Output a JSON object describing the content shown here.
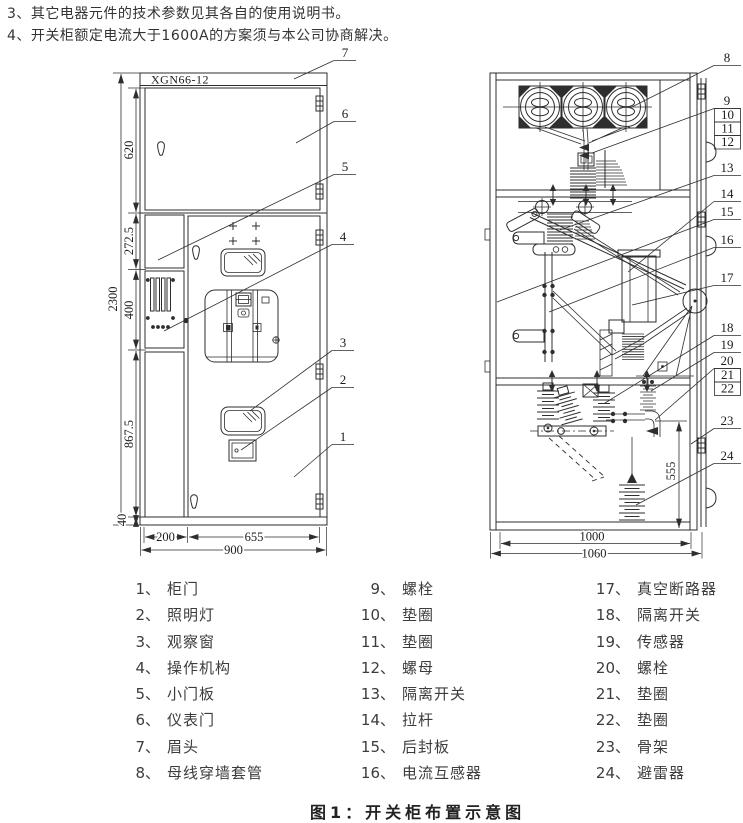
{
  "notes": [
    "3、其它电器元件的技术参数见其各自的使用说明书。",
    "4、开关柜额定电流大于1600A的方案须与本公司协商解决。"
  ],
  "front_view": {
    "model_label": "XGN66-12",
    "overall_height": "2300",
    "section_heights": [
      "620",
      "272.5",
      "400",
      "867.5",
      "40"
    ],
    "widths": [
      "200",
      "655",
      "900"
    ],
    "callouts": [
      "7",
      "6",
      "5",
      "4",
      "3",
      "2",
      "1"
    ]
  },
  "side_view": {
    "inner_height": "555",
    "widths": [
      "1000",
      "1060"
    ],
    "callouts": [
      "8",
      "9",
      "10",
      "11",
      "12",
      "13",
      "14",
      "15",
      "16",
      "17",
      "18",
      "19",
      "20",
      "21",
      "22",
      "23",
      "24"
    ]
  },
  "legend": [
    {
      "num": "1、",
      "label": "柜门"
    },
    {
      "num": "2、",
      "label": "照明灯"
    },
    {
      "num": "3、",
      "label": "观察窗"
    },
    {
      "num": "4、",
      "label": "操作机构"
    },
    {
      "num": "5、",
      "label": "小门板"
    },
    {
      "num": "6、",
      "label": "仪表门"
    },
    {
      "num": "7、",
      "label": "眉头"
    },
    {
      "num": "8、",
      "label": "母线穿墙套管"
    },
    {
      "num": "9、",
      "label": "螺栓"
    },
    {
      "num": "10、",
      "label": "垫圈"
    },
    {
      "num": "11、",
      "label": "垫圈"
    },
    {
      "num": "12、",
      "label": "螺母"
    },
    {
      "num": "13、",
      "label": "隔离开关"
    },
    {
      "num": "14、",
      "label": "拉杆"
    },
    {
      "num": "15、",
      "label": "后封板"
    },
    {
      "num": "16、",
      "label": "电流互感器"
    },
    {
      "num": "17、",
      "label": "真空断路器"
    },
    {
      "num": "18、",
      "label": "隔离开关"
    },
    {
      "num": "19、",
      "label": "传感器"
    },
    {
      "num": "20、",
      "label": "螺栓"
    },
    {
      "num": "21、",
      "label": "垫圈"
    },
    {
      "num": "22、",
      "label": "垫圈"
    },
    {
      "num": "23、",
      "label": "骨架"
    },
    {
      "num": "24、",
      "label": "避雷器"
    }
  ],
  "caption": "图1：开关柜布置示意图"
}
